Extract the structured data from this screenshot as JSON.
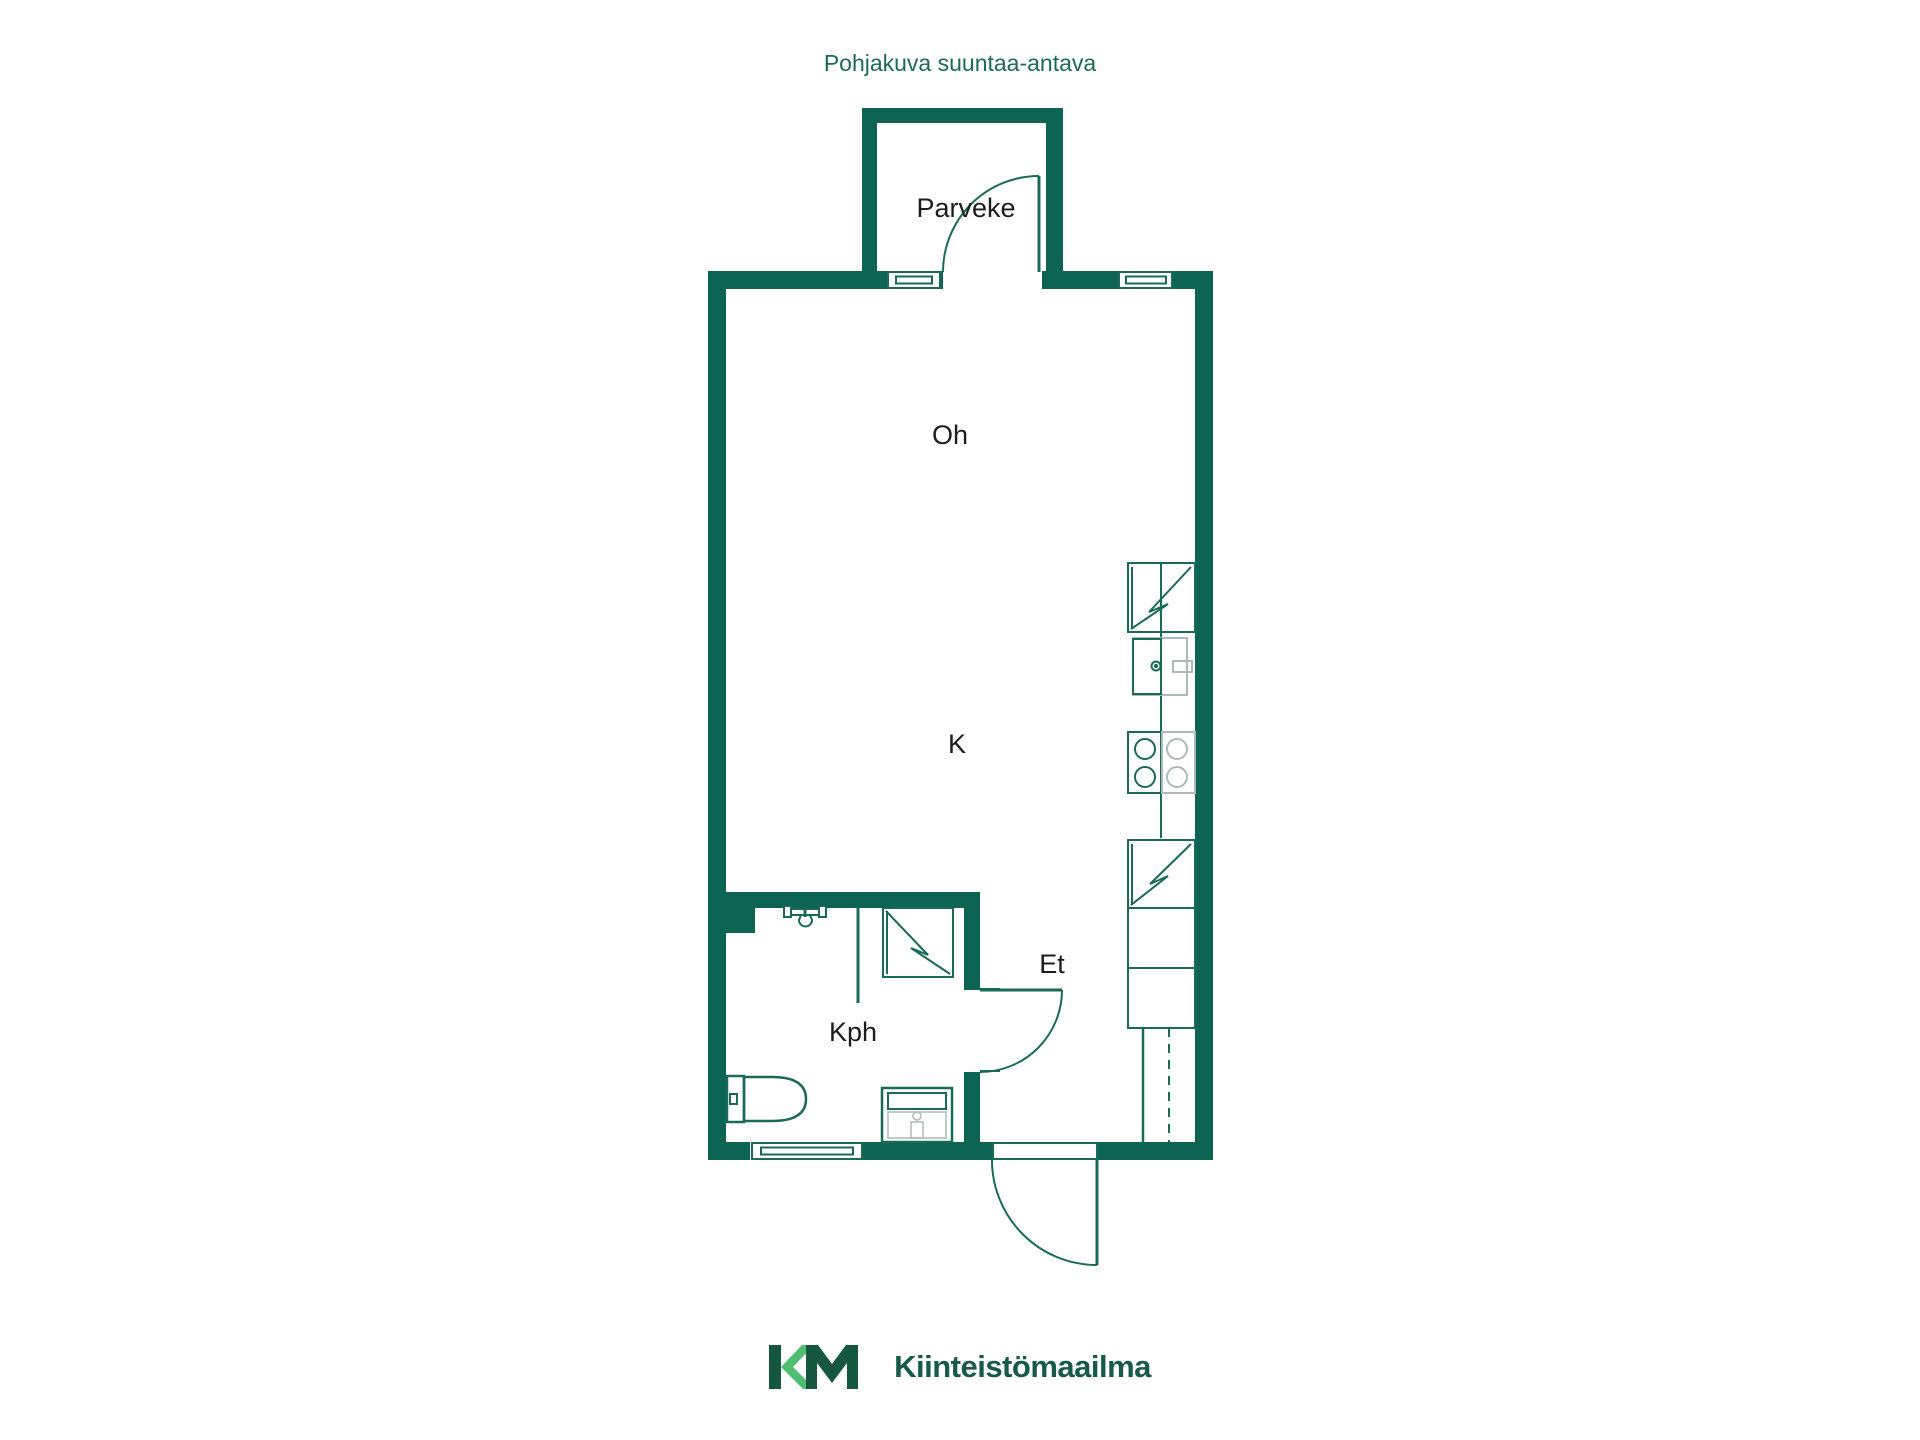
{
  "title": "Pohjakuva suuntaa-antava",
  "rooms": {
    "parveke": "Parveke",
    "oh": "Oh",
    "k": "K",
    "et": "Et",
    "kph": "Kph"
  },
  "footer": {
    "monogram": "KM",
    "company": "Kiinteistömaailma"
  },
  "colors": {
    "wall": "#0D6453",
    "fixture_line": "#1A6A58",
    "fixture_gray": "#AEBAB7",
    "title_text": "#1C6B59",
    "room_label_text": "#1D1D1D",
    "logo_dark_green": "#15573F",
    "logo_light_green": "#4FBE71",
    "background": "#FFFFFF"
  },
  "fixtures": {
    "kitchen": [
      "refrigerator-icon",
      "sink-icon",
      "stove-icon",
      "appliance-icon",
      "cabinet",
      "wardrobe-dashed"
    ],
    "bathroom": [
      "shower-icon",
      "shower-screen",
      "washing-machine-icon",
      "toilet-icon",
      "vanity-sink-icon"
    ],
    "doors": [
      "balcony-door",
      "bathroom-door",
      "entry-door"
    ],
    "window_count": 3
  }
}
